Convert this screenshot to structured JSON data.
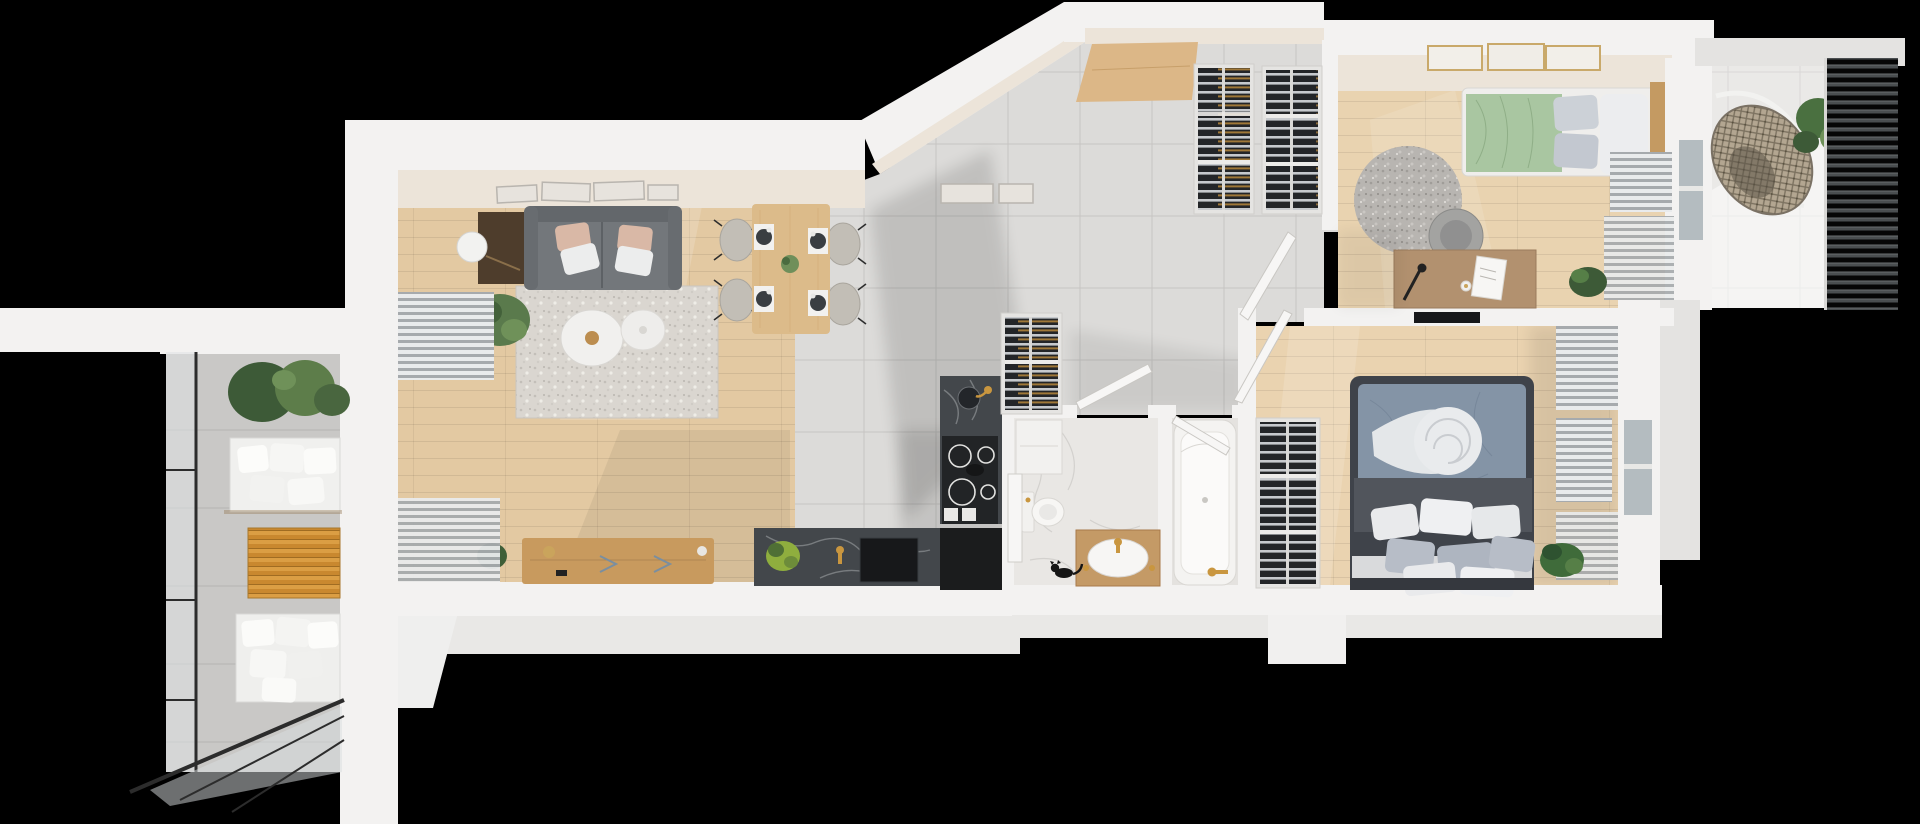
{
  "scene": {
    "kind": "3d-apartment-floor-plan-top-down-render",
    "canvas": {
      "width": 1920,
      "height": 824
    },
    "background": "#000000"
  },
  "palette": {
    "wall": "#f3f2f1",
    "wall_face": "#ece4d9",
    "wood_living": "#e3c9a2",
    "wood_office": "#e9d3b0",
    "wood_bedroom": "#ead3b0",
    "tile": "#dcdbd9",
    "tile_balcony_left": "#c9c8c6",
    "tile_balcony_right": "#eae9e7",
    "marble_floor": "#e9e7e4",
    "marble_counter": "#43474b",
    "sofa": "#73777b",
    "rug": "#dad6d0",
    "rug_round": "#b8b5b1",
    "bed_duvet": "#8494a6",
    "bed_frame": "#3f434a",
    "bedding_green": "#a9c6a1",
    "furniture_wood": "#c89a5e",
    "table_wood": "#dcbb8a",
    "pillow_white": "#e9eaec",
    "pillow_gray": "#b2b9c3",
    "pillow_blush": "#d9b8a6",
    "plant_dark": "#3d5a37",
    "plant_light": "#6f9159",
    "plant_lime": "#8fae3e",
    "gold": "#c9963f",
    "glass": "#b4bcc0",
    "black_island": "#1b1c1d",
    "cat": "#151515"
  },
  "rooms": [
    {
      "id": "balcony-left",
      "furniture": [
        "planter-shrubs",
        "bench-seating-cushions",
        "slatted-wood-table",
        "lounge-cushions",
        "glass-railing",
        "tile-floor"
      ]
    },
    {
      "id": "living-room",
      "furniture": [
        "gallery-wall-art",
        "sofa",
        "throw-pillows",
        "floor-lamp",
        "potted-plant",
        "area-rug",
        "round-coffee-tables",
        "tv-sideboard",
        "small-plant",
        "radiator",
        "window-blinds",
        "balcony-window"
      ]
    },
    {
      "id": "dining-area",
      "furniture": [
        "dining-table",
        "four-chairs",
        "place-settings",
        "centerpiece-plant"
      ]
    },
    {
      "id": "kitchen",
      "furniture": [
        "wall-frames",
        "marble-counter-with-sink",
        "induction-cooktop",
        "black-island-unit",
        "low-marble-counter",
        "counter-sink",
        "counter-plant",
        "gold-faucet"
      ]
    },
    {
      "id": "entrance-hall",
      "furniture": [
        "entry-cabinet",
        "wardrobe-a",
        "wardrobe-b"
      ]
    },
    {
      "id": "corridor",
      "furniture": [
        "hall-wardrobe",
        "open-doors"
      ]
    },
    {
      "id": "bathroom",
      "furniture": [
        "washer-cabinet",
        "shower-screen",
        "toilet",
        "wood-vanity-with-basin",
        "gold-fixtures",
        "black-cat"
      ]
    },
    {
      "id": "bathtub-room",
      "furniture": [
        "bathtub",
        "gold-faucet"
      ]
    },
    {
      "id": "bedroom",
      "furniture": [
        "double-bed",
        "blue-gray-duvet",
        "white-throw-swirl",
        "pillow-cluster",
        "wardrobe",
        "wall-tv",
        "radiators",
        "curtains",
        "window",
        "plant",
        "open-door"
      ]
    },
    {
      "id": "office",
      "furniture": [
        "single-bed-green-bedding",
        "round-fluffy-rug",
        "desk",
        "office-chair",
        "desk-lamp",
        "papers",
        "three-wall-frames",
        "radiator",
        "curtains",
        "plant",
        "window"
      ]
    },
    {
      "id": "balcony-right",
      "furniture": [
        "hanging-egg-chair",
        "hanging-plant",
        "louvered-screen",
        "tile-floor"
      ]
    }
  ]
}
